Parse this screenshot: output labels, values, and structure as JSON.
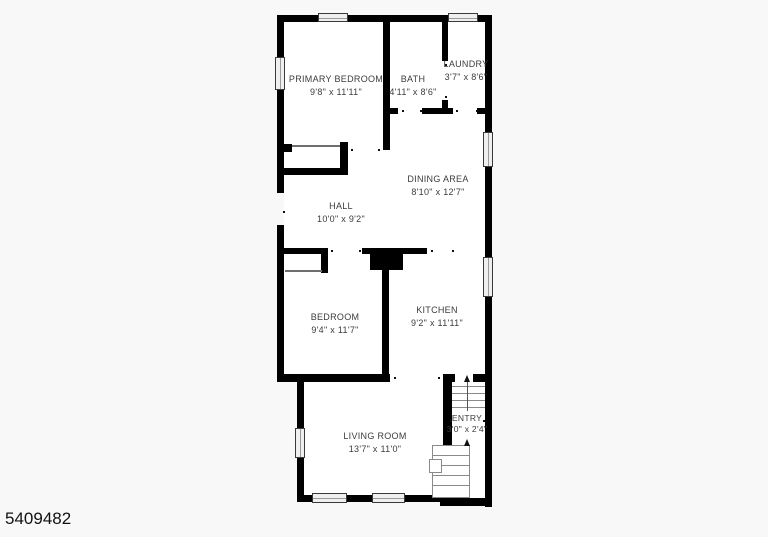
{
  "page": {
    "photo_id": "5409482",
    "background": "#f8f8f8",
    "wall_color": "#000000",
    "label_color": "#3c3c3c"
  },
  "floorplan": {
    "rooms": [
      {
        "id": "primary-bedroom",
        "name": "PRIMARY BEDROOM",
        "dims": "9'8\" x 11'11\""
      },
      {
        "id": "bath",
        "name": "BATH",
        "dims": "4'11\" x 8'6\""
      },
      {
        "id": "laundry",
        "name": "LAUNDRY",
        "dims": "3'7\" x 8'6\""
      },
      {
        "id": "dining-area",
        "name": "DINING AREA",
        "dims": "8'10\" x 12'7\""
      },
      {
        "id": "hall",
        "name": "HALL",
        "dims": "10'0\" x 9'2\""
      },
      {
        "id": "bedroom",
        "name": "BEDROOM",
        "dims": "9'4\" x 11'7\""
      },
      {
        "id": "kitchen",
        "name": "KITCHEN",
        "dims": "9'2\" x 11'11\""
      },
      {
        "id": "living-room",
        "name": "LIVING ROOM",
        "dims": "13'7\" x 11'0\""
      },
      {
        "id": "entry",
        "name": "ENTRY",
        "dims": "3'0\" x 2'4\""
      }
    ]
  }
}
